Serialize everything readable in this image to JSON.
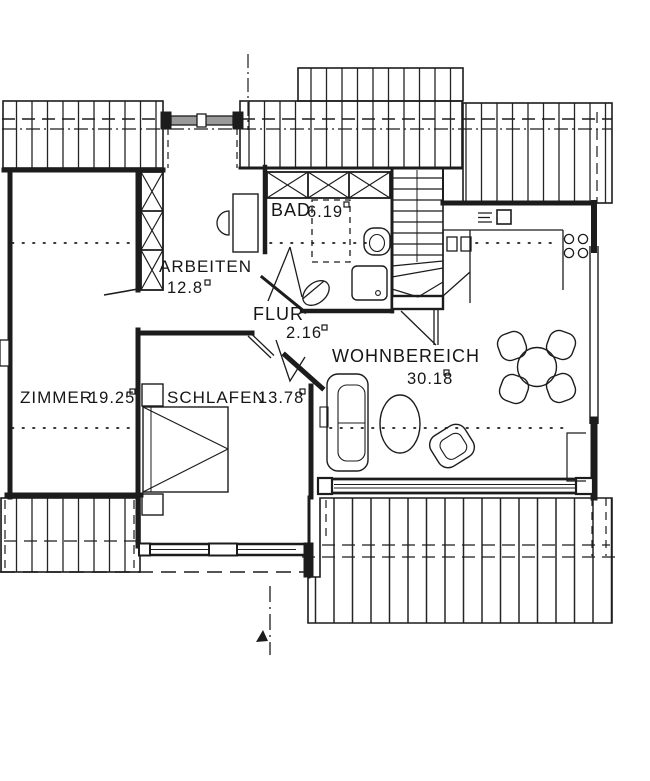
{
  "plan": {
    "title": "Dachgeschoss Grundriss",
    "rooms": [
      {
        "name": "ZIMMER",
        "area": "19.25"
      },
      {
        "name": "SCHLAFEN",
        "area": "13.78"
      },
      {
        "name": "ARBEITEN",
        "area": "12.8"
      },
      {
        "name": "BAD",
        "area": "6.19"
      },
      {
        "name": "FLUR",
        "area": "2.16"
      },
      {
        "name": "WOHNBEREICH",
        "area": "30.18"
      }
    ],
    "unit": "m2",
    "colors": {
      "ink": "#1c1c1c",
      "paper": "#ffffff",
      "glazing": "#9a9a9a"
    }
  }
}
